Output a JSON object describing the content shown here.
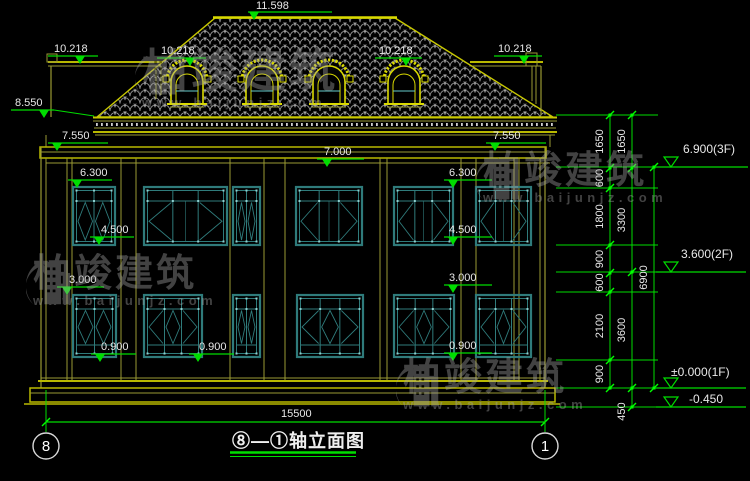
{
  "palette": {
    "yellow": "#b9b900",
    "yellow_dim": "#9a9a33",
    "yellow_bright": "#d9d900",
    "teal": "#2f7b7b",
    "teal_light": "#8fd0d0",
    "cyan": "#66cccc",
    "green": "#00dd00",
    "text": "#e8e8e8",
    "tile": "#b5b5b5",
    "circle": "#d9d9d9"
  },
  "title": {
    "text": "⑧—①轴立面图"
  },
  "axes": {
    "left": "8",
    "right": "1"
  },
  "bottom_dim": {
    "text": "15500"
  },
  "watermark": {
    "brand": "柏竣建筑",
    "url": "www.baijunjz.com"
  },
  "elevation_marks": [
    {
      "text": "11.598",
      "tx": 256,
      "ty": 9,
      "x1": 248,
      "x2": 332,
      "ly": 12,
      "ax": 254
    },
    {
      "text": "10.218",
      "tx": 54,
      "ty": 52,
      "x1": 48,
      "x2": 98,
      "ly": 56,
      "ax": 80
    },
    {
      "text": "10.218",
      "tx": 161,
      "ty": 54,
      "x1": 157,
      "x2": 206,
      "ly": 58,
      "ax": 190
    },
    {
      "text": "10.218",
      "tx": 379,
      "ty": 54,
      "x1": 375,
      "x2": 422,
      "ly": 58,
      "ax": 406
    },
    {
      "text": "10.218",
      "tx": 498,
      "ty": 52,
      "x1": 494,
      "x2": 542,
      "ly": 56,
      "ax": 524
    },
    {
      "text": "8.550",
      "tx": 15,
      "ty": 106,
      "x1": 11,
      "x2": 54,
      "ly": 110,
      "ax": 44,
      "leader": [
        54,
        110,
        94,
        116
      ]
    },
    {
      "text": "7.550",
      "tx": 62,
      "ty": 139,
      "x1": 48,
      "x2": 108,
      "ly": 143,
      "ax": 57
    },
    {
      "text": "7.550",
      "tx": 493,
      "ty": 139,
      "x1": 486,
      "x2": 546,
      "ly": 143,
      "ax": 495
    },
    {
      "text": "7.000",
      "tx": 324,
      "ty": 155,
      "x1": 317,
      "x2": 364,
      "ly": 159,
      "ax": 327
    },
    {
      "text": "6.300",
      "tx": 80,
      "ty": 176,
      "x1": 68,
      "x2": 112,
      "ly": 180,
      "ax": 77
    },
    {
      "text": "6.300",
      "tx": 449,
      "ty": 176,
      "x1": 444,
      "x2": 492,
      "ly": 180,
      "ax": 453
    },
    {
      "text": "4.500",
      "tx": 101,
      "ty": 233,
      "x1": 90,
      "x2": 134,
      "ly": 237,
      "ax": 99
    },
    {
      "text": "4.500",
      "tx": 449,
      "ty": 233,
      "x1": 444,
      "x2": 492,
      "ly": 237,
      "ax": 453
    },
    {
      "text": "3.000",
      "tx": 69,
      "ty": 283,
      "x1": 57,
      "x2": 104,
      "ly": 287,
      "ax": 67
    },
    {
      "text": "3.000",
      "tx": 449,
      "ty": 281,
      "x1": 444,
      "x2": 492,
      "ly": 285,
      "ax": 453
    },
    {
      "text": "0.900",
      "tx": 101,
      "ty": 350,
      "x1": 91,
      "x2": 136,
      "ly": 354,
      "ax": 100
    },
    {
      "text": "0.900",
      "tx": 199,
      "ty": 350,
      "x1": 189,
      "x2": 234,
      "ly": 354,
      "ax": 198
    },
    {
      "text": "0.900",
      "tx": 449,
      "ty": 349,
      "x1": 444,
      "x2": 492,
      "ly": 353,
      "ax": 453
    }
  ],
  "level_marks": [
    {
      "text": "6.900(3F)",
      "tx": 683,
      "ty": 153,
      "x1": 656,
      "x2": 748,
      "ly": 167,
      "ax": 671
    },
    {
      "text": "3.600(2F)",
      "tx": 681,
      "ty": 258,
      "x1": 656,
      "x2": 746,
      "ly": 272,
      "ax": 671
    },
    {
      "text": "±0.000(1F)",
      "tx": 671,
      "ty": 376,
      "x1": 656,
      "x2": 746,
      "ly": 388,
      "ax": 671
    },
    {
      "text": "-0.450",
      "tx": 689,
      "ty": 403,
      "x1": 656,
      "x2": 746,
      "ly": 407,
      "ax": 671
    }
  ],
  "dim_chains": [
    {
      "x": 610,
      "label_x": 603,
      "boundaries": [
        115,
        168,
        188,
        245,
        273,
        292,
        360,
        388
      ],
      "labels": [
        "1650",
        "600",
        "1800",
        "900",
        "600",
        "2100",
        "900"
      ]
    },
    {
      "x": 632,
      "label_x": 625,
      "boundaries": [
        115,
        168,
        272,
        388,
        407
      ],
      "labels": [
        "1650",
        "3300",
        "3600",
        "450"
      ]
    },
    {
      "x": 654,
      "label_x": 647,
      "boundaries": [
        167,
        388
      ],
      "labels": [
        "6900"
      ]
    }
  ],
  "extension_lines": {
    "ys": [
      115,
      167,
      188,
      245,
      272,
      292,
      360,
      388,
      407
    ],
    "x1": 556,
    "x2": 658
  },
  "drawing": {
    "roof": {
      "poly": "97,117 215,18 395,18 553,117",
      "ridge": [
        213,
        17.5,
        397,
        17.5
      ]
    },
    "dormers": {
      "centers": [
        187,
        262,
        329,
        404
      ]
    },
    "pilasters": [
      41,
      46,
      67,
      72,
      121,
      136,
      230,
      264,
      285,
      380,
      387,
      461,
      476,
      514,
      519,
      540,
      545
    ],
    "windows": {
      "f2": {
        "y": 186,
        "h": 60,
        "items": [
          {
            "x": 72,
            "w": 44,
            "t": "nw"
          },
          {
            "x": 143,
            "w": 85,
            "t": "wd"
          },
          {
            "x": 232,
            "w": 29,
            "t": "sl"
          },
          {
            "x": 295,
            "w": 68,
            "t": "wd"
          },
          {
            "x": 393,
            "w": 61,
            "t": "wd"
          },
          {
            "x": 475,
            "w": 57,
            "t": "wd"
          }
        ]
      },
      "f1": {
        "y": 294,
        "h": 64,
        "rail": true,
        "items": [
          {
            "x": 72,
            "w": 45,
            "t": "nw"
          },
          {
            "x": 143,
            "w": 60,
            "t": "wd",
            "cd": true
          },
          {
            "x": 232,
            "w": 29,
            "t": "sl"
          },
          {
            "x": 296,
            "w": 68,
            "t": "wd",
            "cd": true
          },
          {
            "x": 393,
            "w": 62,
            "t": "wd",
            "cd": true
          },
          {
            "x": 475,
            "w": 57,
            "t": "wd",
            "cd": true
          }
        ]
      }
    }
  }
}
